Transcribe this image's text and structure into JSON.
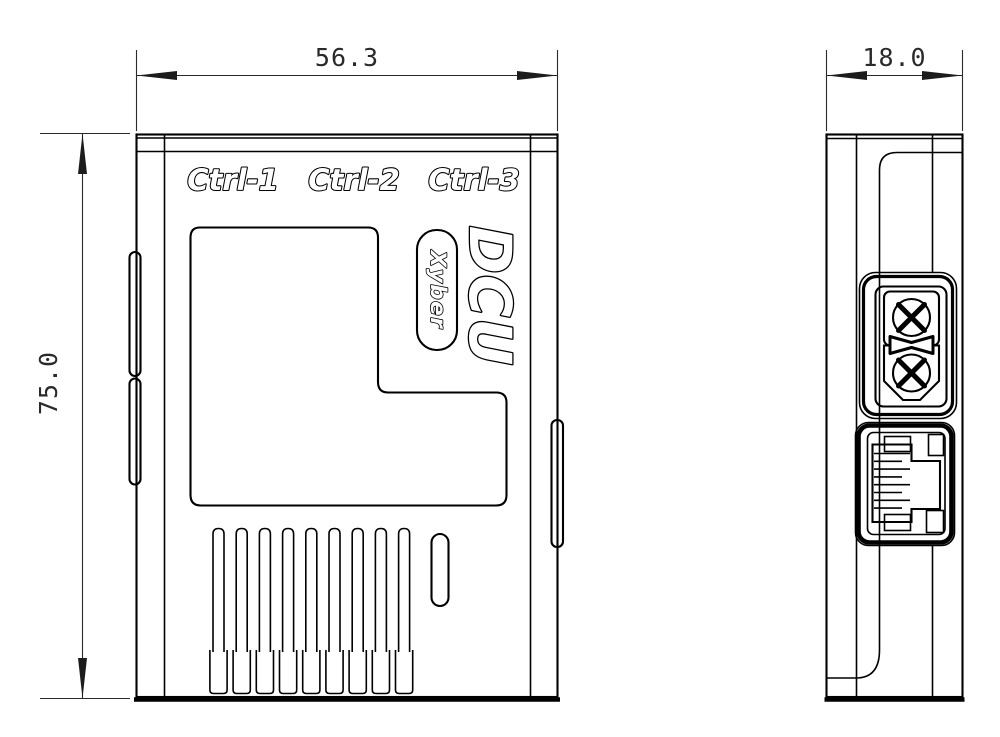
{
  "drawing": {
    "front_view": {
      "port_labels": [
        "Ctrl-1",
        "Ctrl-2",
        "Ctrl-3"
      ],
      "product": "DCU",
      "brand": "Xyber",
      "width_dim": "56.3",
      "height_dim": "75.0"
    },
    "side_view": {
      "depth_dim": "18.0"
    },
    "style": {
      "line_color": "#000000",
      "dimension_color": "#2a2a2a",
      "background": "#ffffff"
    }
  }
}
